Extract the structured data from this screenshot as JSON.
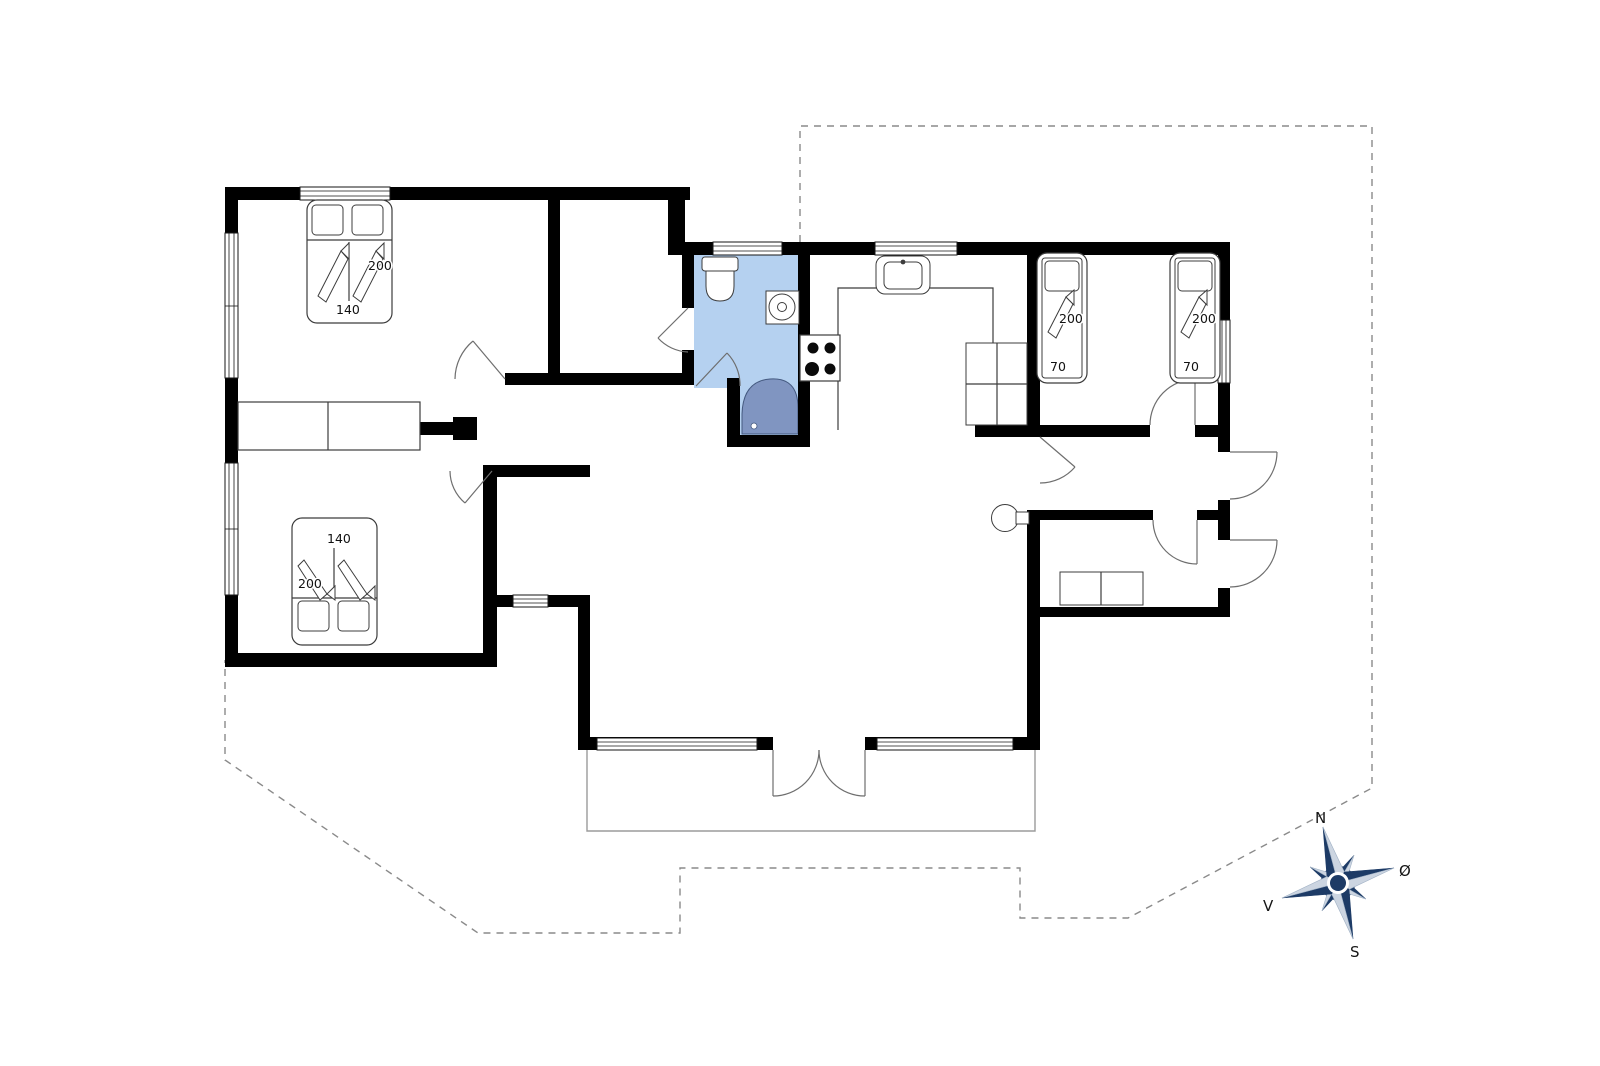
{
  "colors": {
    "wall_black": "#000000",
    "bathroom_floor": "#b5d1f0",
    "shower_fill": "#8095c1",
    "compass_navy": "#1d3b66",
    "line_gray": "#3c3c3c",
    "dashed_gray": "#8a8a8a"
  },
  "beds": {
    "double_top": {
      "length": "200",
      "width": "140"
    },
    "double_bottom": {
      "length": "200",
      "width": "140"
    },
    "single_left": {
      "length": "200",
      "width": "70"
    },
    "single_right": {
      "length": "200",
      "width": "70"
    }
  },
  "compass": {
    "n": "N",
    "e": "Ø",
    "s": "S",
    "v": "V"
  }
}
